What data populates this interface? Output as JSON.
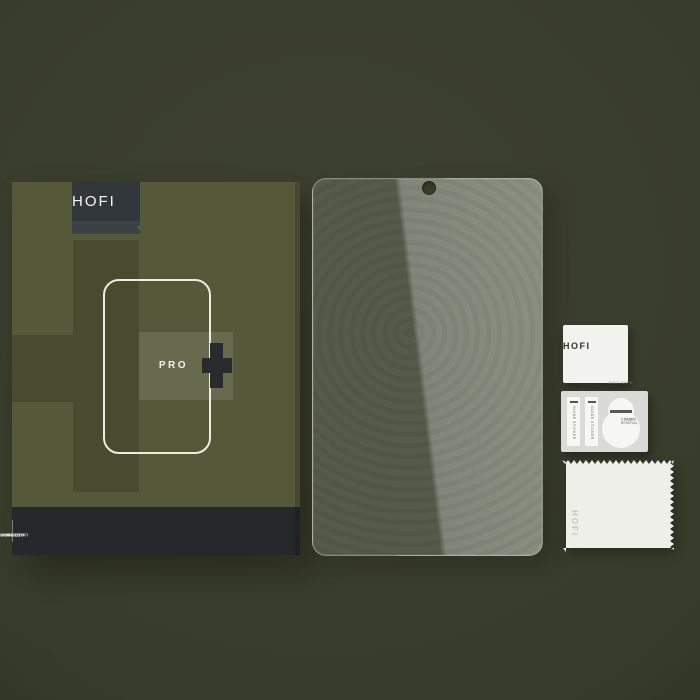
{
  "box": {
    "brand": "HOFI",
    "tagline": "COMPLETE PROTECTION",
    "model_label": "PRO",
    "features": [
      {
        "line1": "ANTI",
        "line2": "FINGERPRINT"
      },
      {
        "line1": "SCRATCH",
        "line2": "RESISTANT"
      },
      {
        "line1": "IMPACT",
        "line2": "ABSORPTION"
      }
    ]
  },
  "accessories": {
    "wet_wipe": {
      "brand": "HOFI",
      "label": "WET WIPE"
    },
    "guide_stickers": [
      {
        "label": "GUIDE STICKER"
      },
      {
        "label": "GUIDE STICKER"
      }
    ],
    "dust_removal_sticker": {
      "line1": "DUST REMOVAL",
      "line2": "STICKER"
    },
    "cloth": {
      "brand": "HOFI"
    }
  },
  "icons": {
    "plus_icon": "plus",
    "camera_hole_icon": "camera-hole"
  },
  "colors": {
    "background": "#383c2a",
    "box_front": "#555839",
    "box_panel_dark": "#484b2e",
    "logo_plate": "#31373b",
    "footer_bar": "#26292b",
    "plus_dark": "#272b2d",
    "glass_dark": "#565a4a",
    "glass_light": "#82867a",
    "accessory_white": "#f2f2ee",
    "sticker_card_gray": "#dadad6"
  }
}
